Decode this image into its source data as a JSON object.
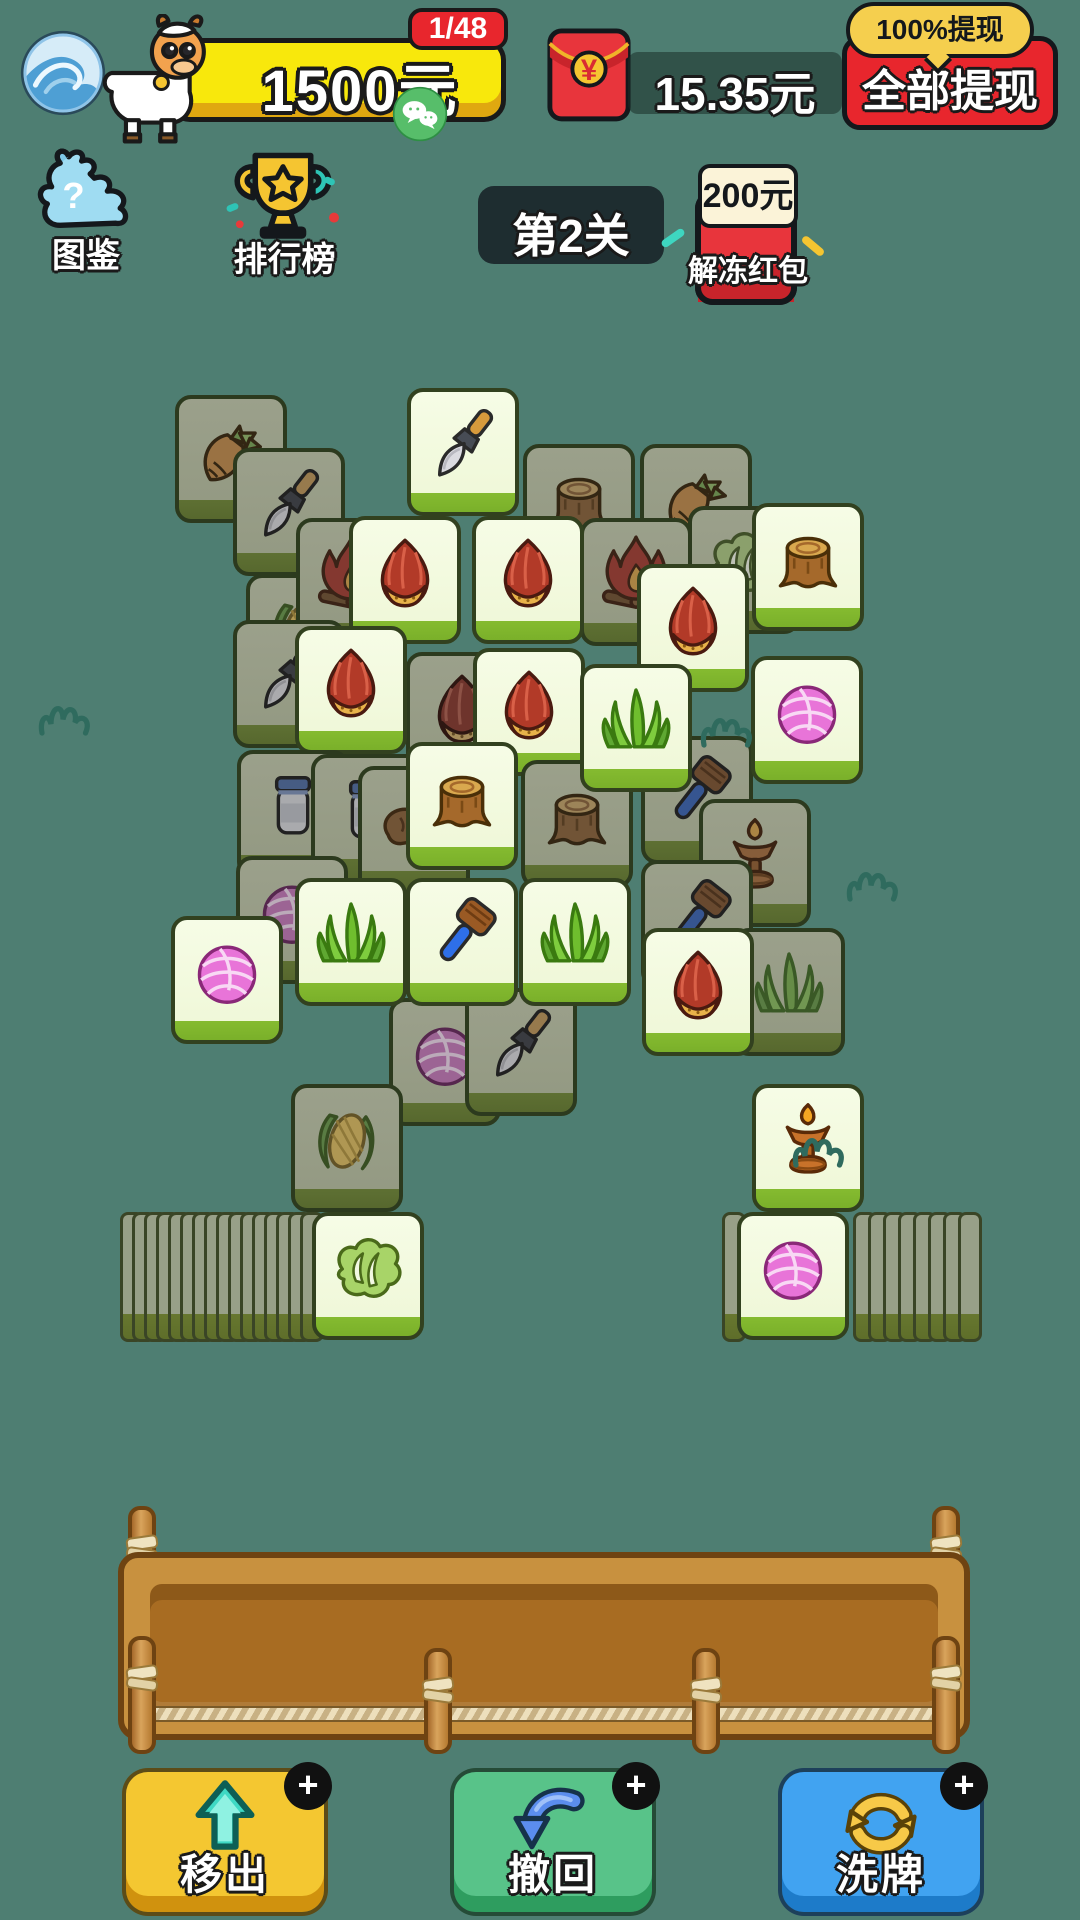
{
  "colors": {
    "background": "#4E7E72",
    "banner_yellow": "#F8E80C",
    "badge_red": "#E8262D",
    "bubble_gold": "#F5CF4E",
    "bright_tile_face": "#F6FCE6",
    "dim_tile_face": "#9BA08B",
    "tile_edge_green": "#85BB30"
  },
  "header": {
    "avatar_icon": "wave-avatar-icon",
    "mascot_icon": "goat-mascot-icon",
    "money_amount": "1500元",
    "progress_badge": "1/48",
    "wechat_icon": "wechat-icon",
    "packet_icon": "red-envelope-icon",
    "balance_amount": "15.35元",
    "withdraw_bubble": "100%提现",
    "withdraw_button": "全部提现"
  },
  "toolbar": {
    "tujian_icon": "goat-question-icon",
    "tujian_label": "图鉴",
    "leaderboard_icon": "trophy-icon",
    "leaderboard_label": "排行榜",
    "level_label": "第2关",
    "unfreeze_icon": "red-envelope-icon",
    "unfreeze_badge": "200元",
    "unfreeze_label": "解冻红包"
  },
  "board": {
    "tile_width": 112,
    "tile_height": 128,
    "tiles": [
      {
        "icon": "carrot",
        "x": 175,
        "y": 395,
        "state": "dim"
      },
      {
        "icon": "brush",
        "x": 233,
        "y": 448,
        "state": "dim"
      },
      {
        "icon": "stump",
        "x": 523,
        "y": 444,
        "state": "dim"
      },
      {
        "icon": "carrot",
        "x": 640,
        "y": 444,
        "state": "dim"
      },
      {
        "icon": "brush",
        "x": 407,
        "y": 388,
        "state": "bright"
      },
      {
        "icon": "corn",
        "x": 246,
        "y": 574,
        "state": "dim"
      },
      {
        "icon": "fire",
        "x": 296,
        "y": 518,
        "state": "dim"
      },
      {
        "icon": "fire",
        "x": 580,
        "y": 518,
        "state": "dim"
      },
      {
        "icon": "cabbage",
        "x": 688,
        "y": 506,
        "state": "dim"
      },
      {
        "icon": "chestnut",
        "x": 349,
        "y": 516,
        "state": "bright"
      },
      {
        "icon": "chestnut",
        "x": 472,
        "y": 516,
        "state": "bright"
      },
      {
        "icon": "stump",
        "x": 752,
        "y": 503,
        "state": "bright"
      },
      {
        "icon": "chestnut",
        "x": 637,
        "y": 564,
        "state": "bright"
      },
      {
        "icon": "brush",
        "x": 233,
        "y": 620,
        "state": "dim"
      },
      {
        "icon": "chestnut",
        "x": 406,
        "y": 652,
        "state": "dim"
      },
      {
        "icon": "chestnut",
        "x": 295,
        "y": 626,
        "state": "bright"
      },
      {
        "icon": "chestnut",
        "x": 473,
        "y": 648,
        "state": "bright"
      },
      {
        "icon": "jar",
        "x": 237,
        "y": 750,
        "state": "dim"
      },
      {
        "icon": "jar",
        "x": 311,
        "y": 754,
        "state": "dim"
      },
      {
        "icon": "bread",
        "x": 358,
        "y": 766,
        "state": "dim"
      },
      {
        "icon": "stump",
        "x": 521,
        "y": 760,
        "state": "dim"
      },
      {
        "icon": "brush2",
        "x": 641,
        "y": 736,
        "state": "dim"
      },
      {
        "icon": "grass",
        "x": 580,
        "y": 664,
        "state": "bright"
      },
      {
        "icon": "yarn",
        "x": 751,
        "y": 656,
        "state": "bright"
      },
      {
        "icon": "stump",
        "x": 406,
        "y": 742,
        "state": "bright"
      },
      {
        "icon": "lamp",
        "x": 699,
        "y": 799,
        "state": "dim"
      },
      {
        "icon": "yarn",
        "x": 236,
        "y": 856,
        "state": "dim"
      },
      {
        "icon": "brush2",
        "x": 641,
        "y": 860,
        "state": "dim"
      },
      {
        "icon": "yarn",
        "x": 389,
        "y": 998,
        "state": "dim"
      },
      {
        "icon": "brush",
        "x": 465,
        "y": 988,
        "state": "dim"
      },
      {
        "icon": "grass",
        "x": 295,
        "y": 878,
        "state": "bright"
      },
      {
        "icon": "brush2",
        "x": 406,
        "y": 878,
        "state": "bright"
      },
      {
        "icon": "grass",
        "x": 519,
        "y": 878,
        "state": "bright"
      },
      {
        "icon": "yarn",
        "x": 171,
        "y": 916,
        "state": "bright"
      },
      {
        "icon": "grass",
        "x": 733,
        "y": 928,
        "state": "dim"
      },
      {
        "icon": "chestnut",
        "x": 642,
        "y": 928,
        "state": "bright"
      },
      {
        "icon": "corn",
        "x": 291,
        "y": 1084,
        "state": "dim"
      },
      {
        "icon": "lamp",
        "x": 752,
        "y": 1084,
        "state": "bright"
      }
    ]
  },
  "stacks": [
    {
      "name": "left-stack",
      "x": 120,
      "y": 1212,
      "pitch": 12,
      "items": [
        {
          "facedown": 16
        },
        {
          "faceup": "cabbage"
        }
      ]
    },
    {
      "name": "right-stack",
      "x": 722,
      "y": 1212,
      "pitch": 15,
      "items": [
        {
          "facedown": 1
        },
        {
          "faceup": "yarn"
        },
        {
          "facedown": 8
        }
      ]
    }
  ],
  "doodles": [
    {
      "x": 36,
      "y": 694
    },
    {
      "x": 698,
      "y": 706
    },
    {
      "x": 844,
      "y": 860
    },
    {
      "x": 790,
      "y": 1126
    }
  ],
  "actions": [
    {
      "label": "移出",
      "icon": "move-out-arrow-icon",
      "color": "#F4C731",
      "edge": "#D0920E",
      "plus": "+"
    },
    {
      "label": "撤回",
      "icon": "undo-arrow-icon",
      "color": "#58C389",
      "edge": "#2E9D5F",
      "plus": "+"
    },
    {
      "label": "洗牌",
      "icon": "shuffle-arrows-icon",
      "color": "#41A3F1",
      "edge": "#1D7BC9",
      "plus": "+"
    }
  ]
}
